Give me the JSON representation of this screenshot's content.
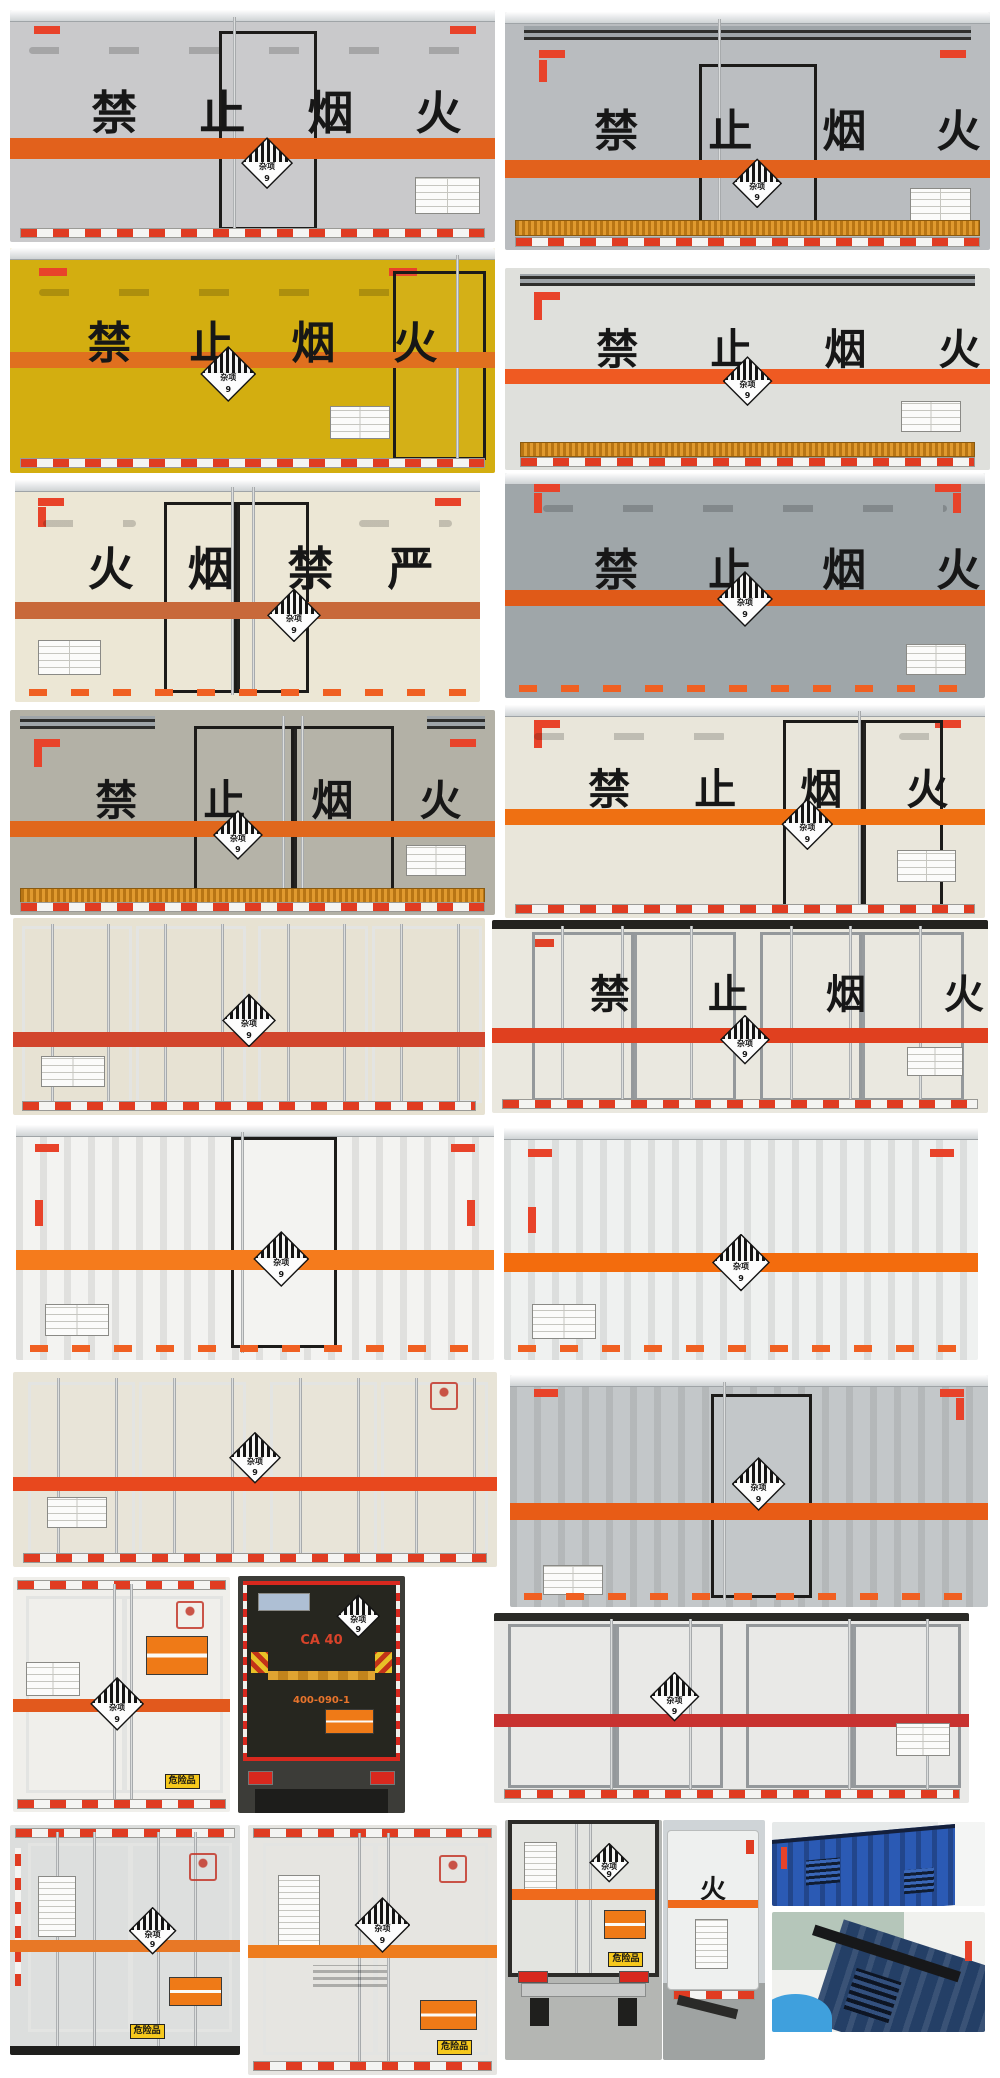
{
  "page": {
    "background": "#ffffff"
  },
  "shared": {
    "placard": {
      "label": "杂项",
      "class_no": "9"
    },
    "danger_sign": "危险品",
    "safety_plate": "安全告示"
  },
  "photos": [
    {
      "name": "box-truck-rear-gray-center-door",
      "box": "#c9c9cb",
      "stripe": "#e2611c",
      "text": "禁止烟火"
    },
    {
      "name": "box-truck-rear-gray-louver-top",
      "box": "#b9bcbf",
      "stripe": "#e2611c",
      "text": "禁止烟火"
    },
    {
      "name": "box-truck-rear-yellow",
      "box": "#d3ae10",
      "stripe": "#e0701f",
      "text": "禁止烟火"
    },
    {
      "name": "box-truck-rear-white-amber-sill",
      "box": "#dfe0dc",
      "stripe": "#ef5a22",
      "text": "禁止烟火"
    },
    {
      "name": "box-truck-rear-cream-reversed-text",
      "box": "#ece7d5",
      "stripe": "#c8693a",
      "text": "火烟禁严"
    },
    {
      "name": "box-truck-rear-slate-gray",
      "box": "#9fa6a9",
      "stripe": "#e05a18",
      "text": "禁止烟火"
    },
    {
      "name": "box-truck-rear-warm-gray-double-door",
      "box": "#b3b1a6",
      "stripe": "#e0671c",
      "text": "禁止烟火"
    },
    {
      "name": "box-truck-rear-cream-right-doors",
      "box": "#e9e6da",
      "stripe": "#ef7012",
      "text": "禁止烟火"
    },
    {
      "name": "box-truck-rear-cream-four-doors",
      "box": "#e7e2d2",
      "stripe": "#d2452c",
      "text": ""
    },
    {
      "name": "box-truck-rear-white-wide-doors",
      "box": "#eae8df",
      "stripe": "#e0401f",
      "text": "禁止烟火"
    },
    {
      "name": "container-van-white-center-door",
      "box": "#f3f3f1",
      "stripe": "#f57b1c",
      "text": ""
    },
    {
      "name": "container-van-white-plain",
      "box": "#eff1f0",
      "stripe": "#f36c0d",
      "text": ""
    },
    {
      "name": "box-truck-rear-cream-rod-doors",
      "box": "#e8e4d7",
      "stripe": "#e8481e",
      "text": ""
    },
    {
      "name": "container-van-gray-center-door",
      "box": "#c3c7c9",
      "stripe": "#e85c16",
      "text": ""
    },
    {
      "name": "box-truck-rear-white-danger-signs",
      "box": "#f0efeb",
      "stripe": "#e2591d",
      "text": ""
    },
    {
      "name": "truck-rear-dark-tail-lift",
      "box": "#26261f",
      "stripe": "#d9931c",
      "text": "",
      "brand": "CA 40",
      "phone": "400-090-1"
    },
    {
      "name": "box-truck-rear-white-red-stripe",
      "box": "#e9e9e7",
      "stripe": "#c83230",
      "text": ""
    },
    {
      "name": "box-truck-rear-silver-doors",
      "box": "#dcdedd",
      "stripe": "#e87826",
      "text": ""
    },
    {
      "name": "box-truck-rear-white-louver-doors",
      "box": "#e6e5e1",
      "stripe": "#ee7d1e",
      "text": ""
    },
    {
      "name": "truck-rear-street-scene",
      "box": "#e3e4e0",
      "stripe": "#ef6a1c",
      "text": ""
    },
    {
      "name": "truck-rear-quarter-view",
      "box": "#eef0ef",
      "stripe": "#ef6a1c",
      "text": "火"
    },
    {
      "name": "blue-container-top",
      "box": "#2b5ab4",
      "stripe": "",
      "text": ""
    },
    {
      "name": "blue-container-corner-detail",
      "box": "#243f66",
      "stripe": "",
      "text": ""
    }
  ]
}
